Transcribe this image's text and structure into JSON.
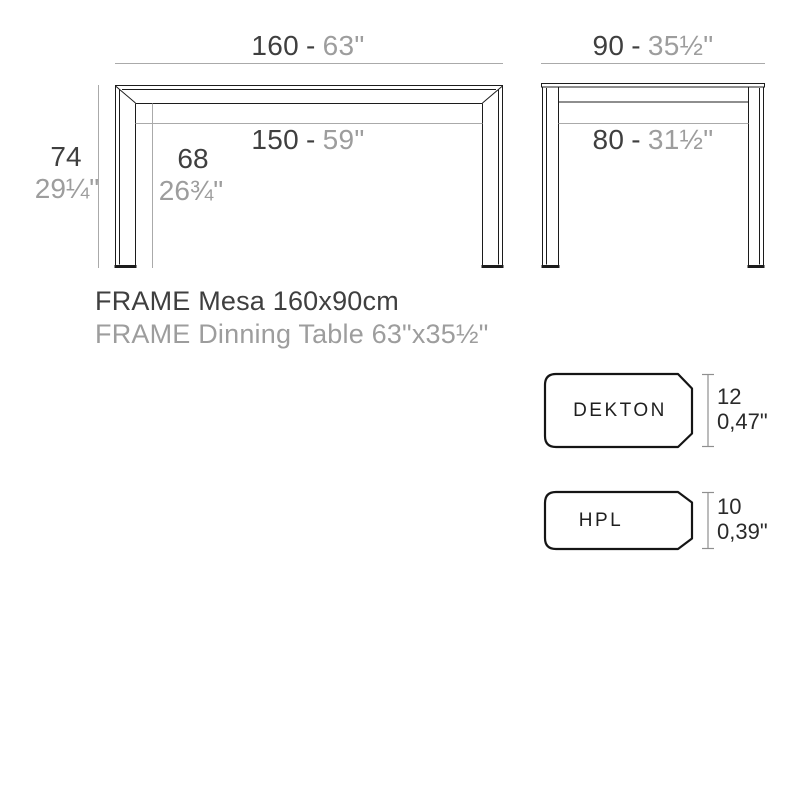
{
  "front_view": {
    "width": {
      "cm": "160",
      "sep": "-",
      "inches": "63\""
    },
    "inner_width": {
      "cm": "150",
      "sep": "-",
      "inches": "59\""
    },
    "height": {
      "cm": "74",
      "inches": "29¼\""
    },
    "clearance_height": {
      "cm": "68",
      "inches": "26¾\""
    }
  },
  "side_view": {
    "depth": {
      "cm": "90",
      "sep": "-",
      "inches": "35½\""
    },
    "inner_depth": {
      "cm": "80",
      "sep": "-",
      "inches": "31½\""
    }
  },
  "title": {
    "line1": "FRAME Mesa 160x90cm",
    "line2": "FRAME Dinning Table 63\"x35½\""
  },
  "materials": [
    {
      "name": "DEKTON",
      "thickness_mm": "12",
      "thickness_inches": "0,47\""
    },
    {
      "name": "HPL",
      "thickness_mm": "10",
      "thickness_inches": "0,39\""
    }
  ],
  "colors": {
    "ink": "#1c1c1c",
    "dimension_line": "#aaaaaa",
    "text_dark": "#3f3f3f",
    "text_gray": "#9d9d9d",
    "background": "#ffffff"
  }
}
